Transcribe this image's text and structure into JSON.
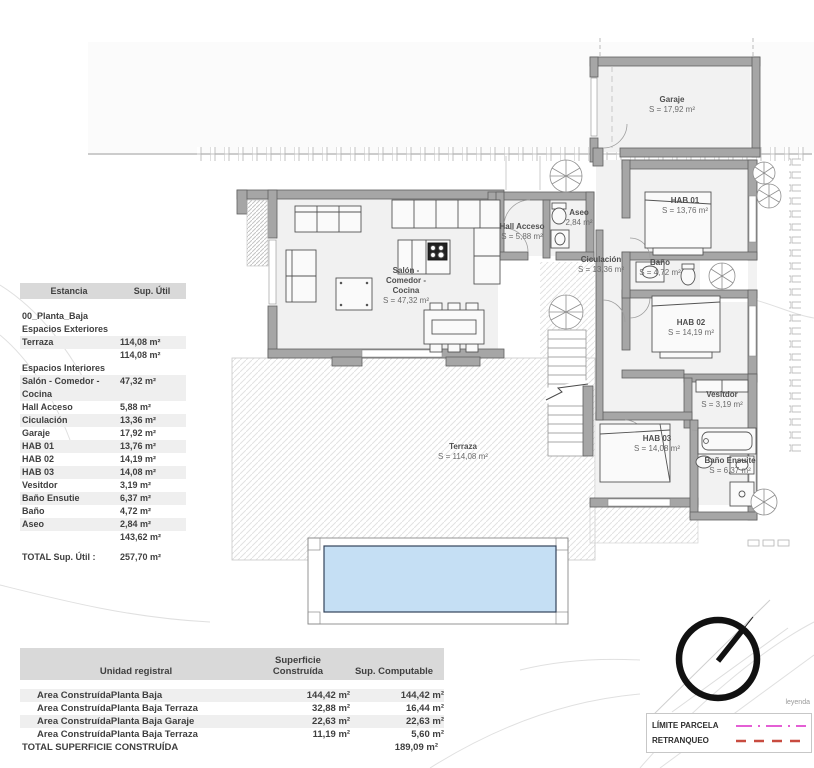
{
  "title": "00_Planta_Baja",
  "plan": {
    "rooms": {
      "garaje": {
        "name": "Garaje",
        "area": "S = 17,92 m²"
      },
      "hab01": {
        "name": "HAB 01",
        "area": "S = 13,76 m²"
      },
      "hab02": {
        "name": "HAB 02",
        "area": "S = 14,19 m²"
      },
      "hab03": {
        "name": "HAB 03",
        "area": "S = 14,08 m²"
      },
      "bano": {
        "name": "Baño",
        "area": "S = 4,72 m²"
      },
      "bano_ensuite": {
        "name": "Baño Ensuite",
        "area": "S = 6,37 m²"
      },
      "vesitdor": {
        "name": "Vesitdor",
        "area": "S = 3,19 m²"
      },
      "aseo": {
        "name": "Aseo",
        "area": "2,84 m²"
      },
      "hall": {
        "name": "Hall Acceso",
        "area": "S = 5,88 m²"
      },
      "ciculacion": {
        "name": "Ciculación",
        "area": "S = 13,36 m²"
      },
      "salon": {
        "line1": "Salón -",
        "line2": "Comedor -",
        "line3": "Cocina",
        "area": "S = 47,32 m²"
      },
      "terraza": {
        "name": "Terraza",
        "area": "S = 114,08 m²"
      }
    }
  },
  "estancia_table": {
    "header": {
      "estancia": "Estancia",
      "sup_util": "Sup. Útil"
    },
    "plant_label": "00_Planta_Baja",
    "section_exteriores": "Espacios Exteriores",
    "section_interiores": "Espacios Interiores",
    "rows_exteriores": [
      {
        "name": "Terraza",
        "value": "114,08 m²"
      },
      {
        "name": "",
        "value": "114,08 m²"
      }
    ],
    "rows_interiores": [
      {
        "name": "Salón - Comedor - Cocina",
        "value": "47,32 m²"
      },
      {
        "name": "Hall Acceso",
        "value": "5,88 m²"
      },
      {
        "name": "Ciculación",
        "value": "13,36 m²"
      },
      {
        "name": "Garaje",
        "value": "17,92 m²"
      },
      {
        "name": "HAB 01",
        "value": "13,76 m²"
      },
      {
        "name": "HAB 02",
        "value": "14,19 m²"
      },
      {
        "name": "HAB 03",
        "value": "14,08 m²"
      },
      {
        "name": "Vesitdor",
        "value": "3,19 m²"
      },
      {
        "name": "Baño Ensutie",
        "value": "6,37 m²"
      },
      {
        "name": "Baño",
        "value": "4,72 m²"
      },
      {
        "name": "Aseo",
        "value": "2,84 m²"
      },
      {
        "name": "",
        "value": "143,62 m²"
      }
    ],
    "total": {
      "label": "TOTAL Sup. Útil :",
      "value": "257,70 m²"
    }
  },
  "construida_table": {
    "header": {
      "unidad": "Unidad registral",
      "superficie": "Superficie Construída",
      "computable": "Sup. Computable"
    },
    "rows": [
      {
        "unidad": "Area ConstruídaPlanta Baja",
        "superficie": "144,42 m²",
        "computable": "144,42 m²"
      },
      {
        "unidad": "Area ConstruídaPlanta Baja Terraza",
        "superficie": "32,88 m²",
        "computable": "16,44 m²"
      },
      {
        "unidad": "Area ConstruídaPlanta Baja Garaje",
        "superficie": "22,63 m²",
        "computable": "22,63 m²"
      },
      {
        "unidad": "Area ConstruídaPlanta Baja Terraza",
        "superficie": "11,19 m²",
        "computable": "5,60 m²"
      }
    ],
    "total": {
      "label": "TOTAL SUPERFICIE CONSTRUÍDA",
      "value": "189,09 m²"
    }
  },
  "legend": {
    "caption": "leyenda",
    "items": [
      {
        "label": "LÍMITE PARCELA",
        "color": "#e45fd5"
      },
      {
        "label": "RETRANQUEO",
        "color": "#c84b40"
      }
    ]
  },
  "colors": {
    "wall": "#a6a6a6",
    "pool_water": "#c5dff4",
    "table_header_bg": "#d9d9d9",
    "row_alt_bg": "#efefef",
    "limite_parcela": "#e45fd5",
    "retranqueo": "#c84b40"
  }
}
